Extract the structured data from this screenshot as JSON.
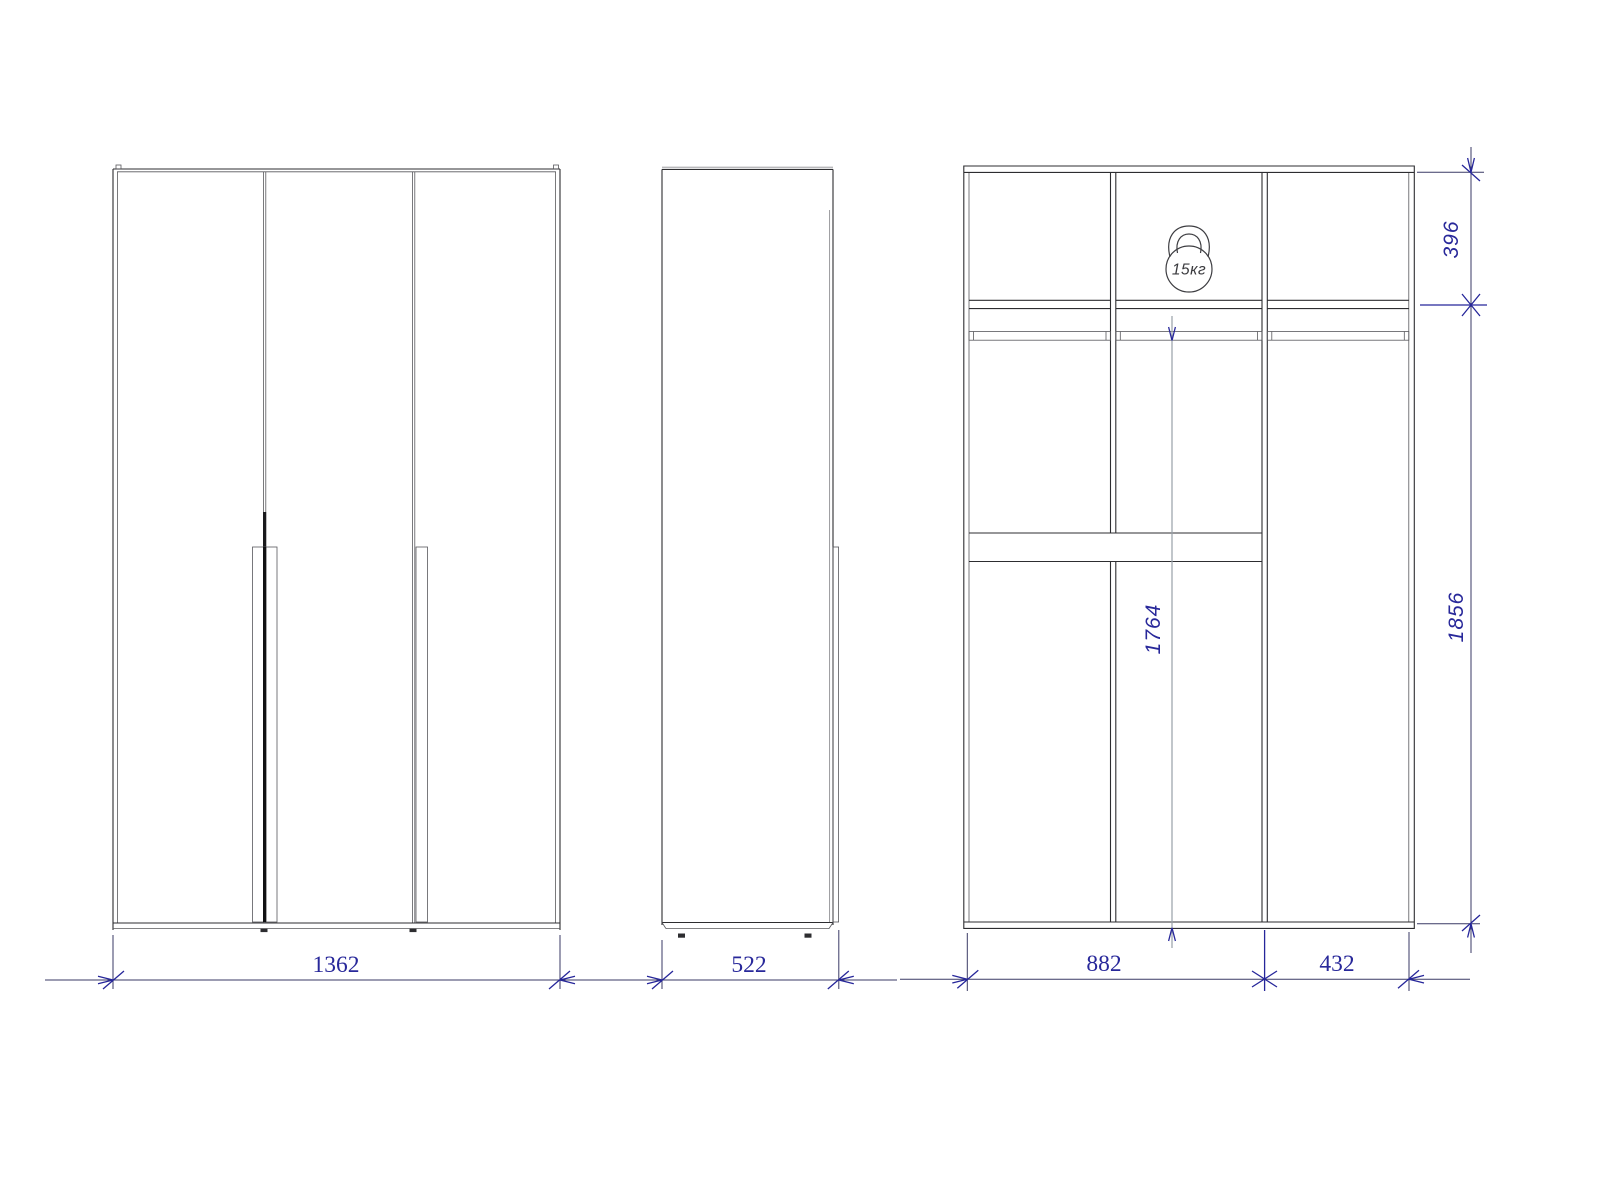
{
  "drawing": {
    "subject": "wardrobe-orthographic-views",
    "background": "#ffffff",
    "line_color": "#2d2d30",
    "dimension_color": "#28289a",
    "views": {
      "front": {
        "overall_width": "1362"
      },
      "side": {
        "depth": "522"
      },
      "interior": {
        "main_section_width": "882",
        "side_section_width": "432",
        "top_shelf_height": "396",
        "overall_height": "1856",
        "interior_height": "1764",
        "max_load": "15кг"
      }
    }
  }
}
